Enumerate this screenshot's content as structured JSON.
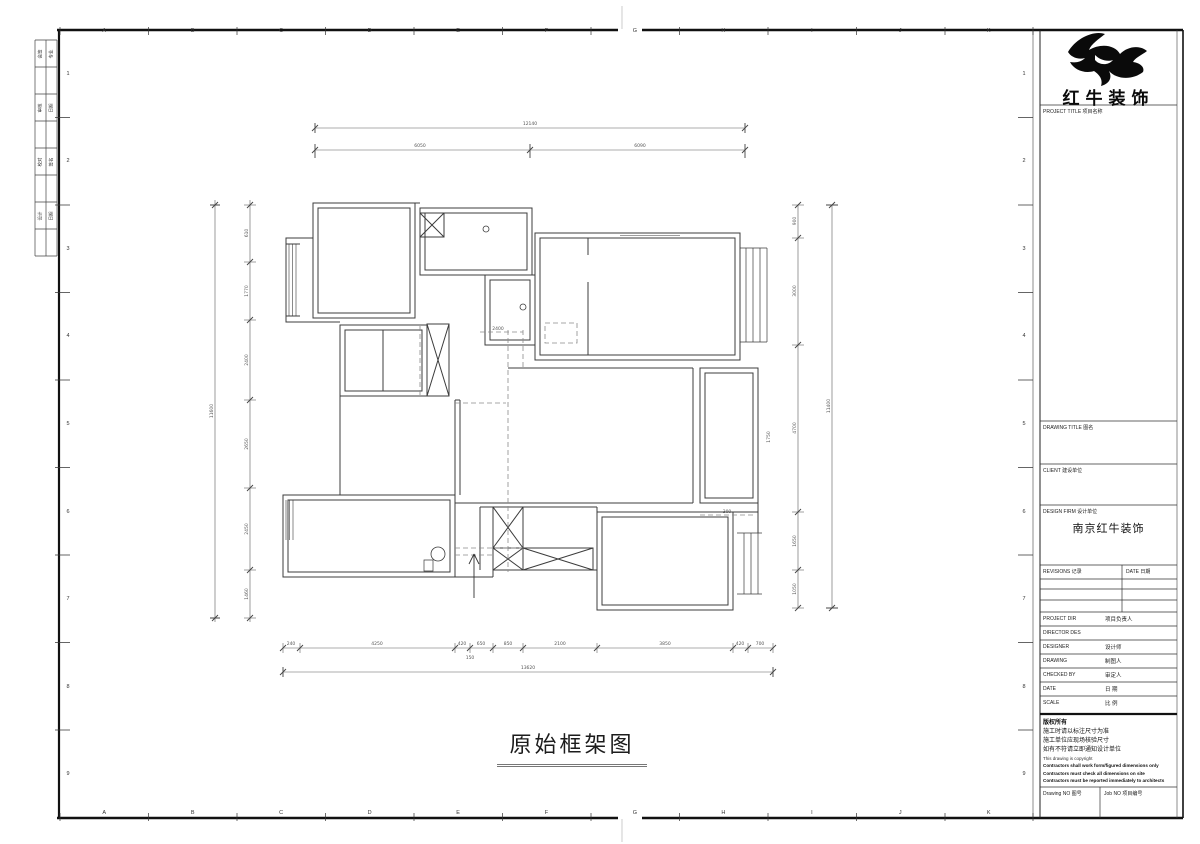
{
  "sheet": {
    "caption": "原始框架图",
    "ruler_letters": [
      "A",
      "B",
      "C",
      "D",
      "E",
      "F",
      "G",
      "H",
      "I",
      "J",
      "K"
    ],
    "ruler_numbers": [
      "1",
      "2",
      "3",
      "4",
      "5",
      "6",
      "7",
      "8",
      "9"
    ],
    "sign_rows": [
      {
        "a": "会签",
        "b": "专业"
      },
      {
        "a": "",
        "b": ""
      },
      {
        "a": "审核",
        "b": "日期"
      },
      {
        "a": "",
        "b": ""
      },
      {
        "a": "校对",
        "b": "签名"
      },
      {
        "a": "",
        "b": ""
      },
      {
        "a": "设计",
        "b": "日期"
      },
      {
        "a": "",
        "b": ""
      }
    ]
  },
  "title_block": {
    "brand": "红牛装饰",
    "project_title": "PROJECT TITLE  项目名称",
    "drawing_title": "DRAWING TITLE  图名",
    "client": "CLIENT  建设单位",
    "design_firm": "DESIGN FIRM  设计单位",
    "design_firm_value": "南京红牛装饰",
    "revisions": "REVISIONS  记录",
    "date_col": "DATE  日期",
    "persons": [
      {
        "en": "PROJECT DIR",
        "cn": "项目负责人"
      },
      {
        "en": "DIRECTOR DES",
        "cn": ""
      },
      {
        "en": "DESIGNER",
        "cn": "设计师"
      },
      {
        "en": "DRAWING",
        "cn": "制图人"
      },
      {
        "en": "CHECKED BY",
        "cn": "审定人"
      },
      {
        "en": "DATE",
        "cn": "日  期"
      },
      {
        "en": "SCALE",
        "cn": "比  例"
      }
    ],
    "copyright": [
      "版权所有",
      "施工时请以标注尺寸为准",
      "施工单位应现场核验尺寸",
      "如有不符请立即通知设计单位",
      "This drawing is copyright",
      "Contractors shall work form/figured dimensions only",
      "Contractors must check all dimensions on site",
      "Contractors must be reported immediately to architects"
    ],
    "drawing_no": "Drawing NO  图号",
    "job_no": "Job NO  项目编号"
  },
  "plan": {
    "dims": {
      "top_overall": "12140",
      "top_segments": [
        "6050",
        "6090"
      ],
      "left_overall": "11600",
      "left_segments": [
        "610",
        "1770",
        "2400",
        "2650",
        "2450",
        "1460"
      ],
      "right_overall": "11400",
      "right_segments": [
        "900",
        "3000",
        "4700",
        "1650",
        "1050"
      ],
      "bottom_overall": "13620",
      "bottom_segments": [
        "240",
        "4250",
        "420",
        "650",
        "850",
        "2100",
        "3850",
        "420",
        "700"
      ],
      "bottom_sub": "150"
    },
    "labels": [
      {
        "t": "2400"
      },
      {
        "t": "1750"
      },
      {
        "t": "300"
      }
    ]
  }
}
